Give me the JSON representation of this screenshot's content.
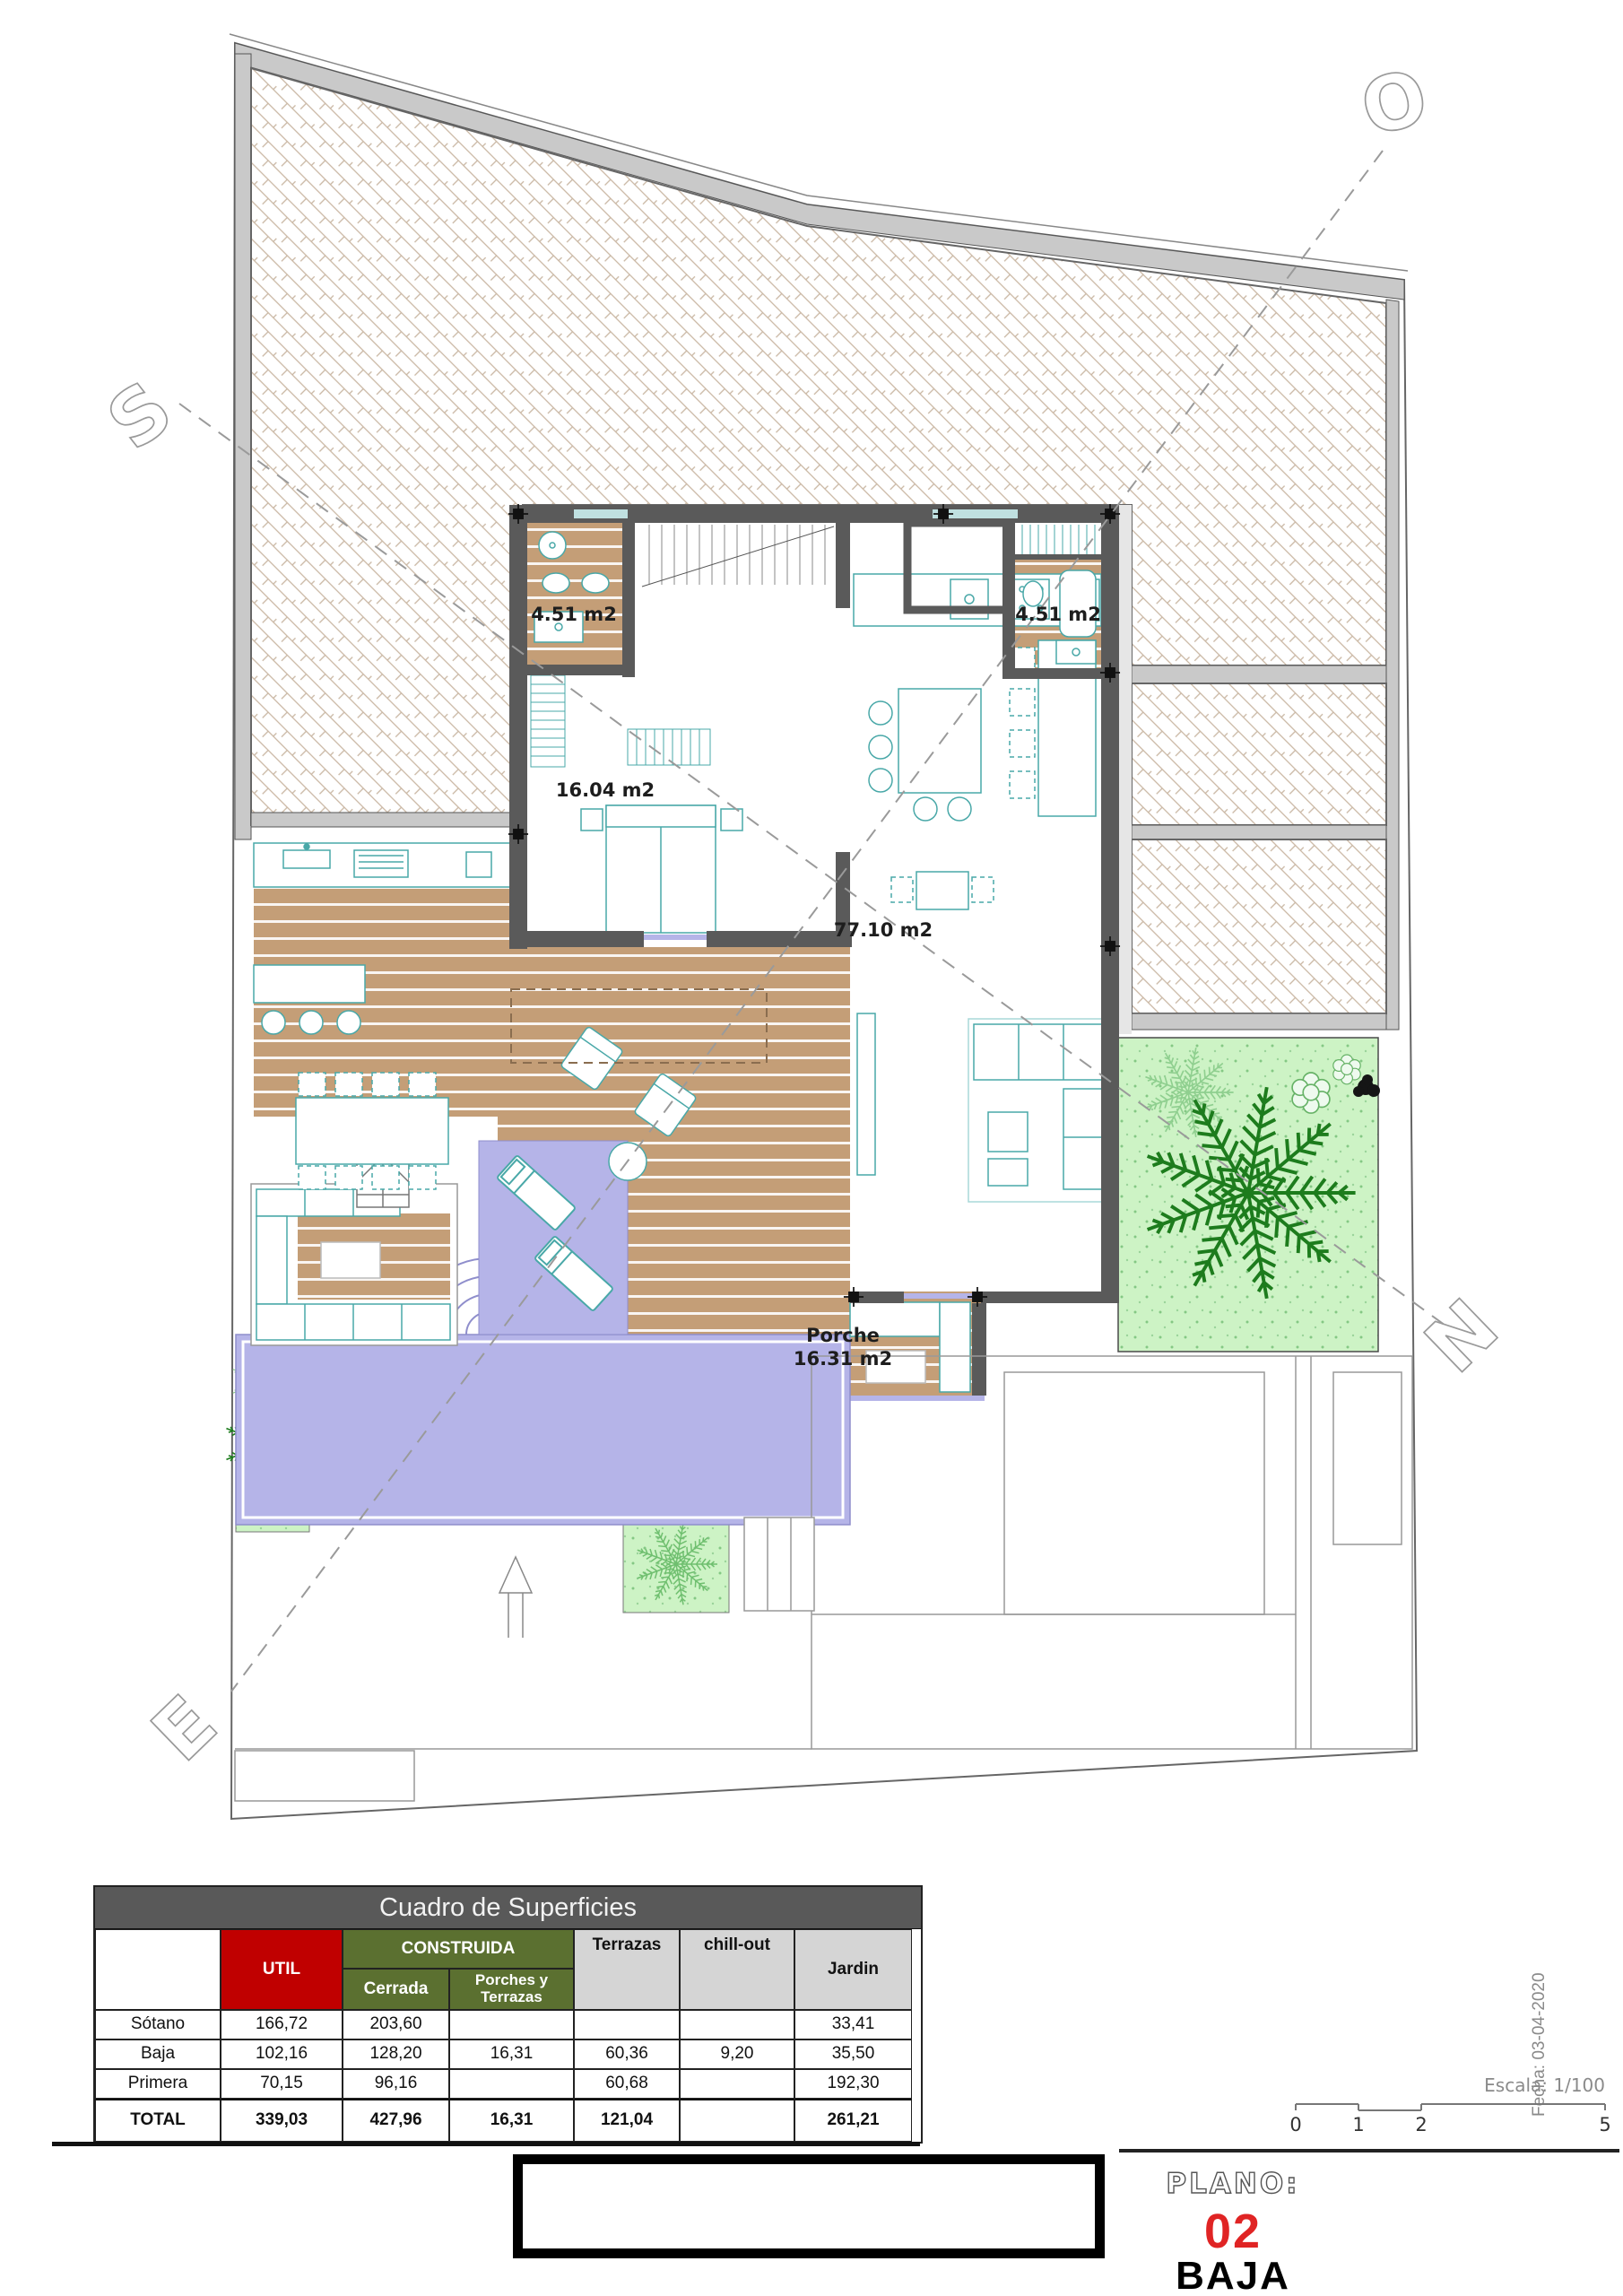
{
  "plan": {
    "compass": {
      "s": "S",
      "o": "O",
      "n": "N",
      "e": "E"
    },
    "labels": {
      "bath_left": "4.51 m2",
      "bath_right": "4.51 m2",
      "bedroom": "16.04 m2",
      "living": "77.10 m2",
      "porch_name": "Porche",
      "porch_area": "16.31 m2"
    }
  },
  "areas_table": {
    "title": "Cuadro de Superficies",
    "headers": {
      "util": "UTIL",
      "construida": "CONSTRUIDA",
      "cerrada": "Cerrada",
      "porches": "Porches y Terrazas",
      "terrazas": "Terrazas",
      "chillout": "chill-out",
      "jardin": "Jardin"
    },
    "rows": [
      {
        "label": "Sótano",
        "util": "166,72",
        "cerrada": "203,60",
        "porches": "",
        "terrazas": "",
        "chillout": "",
        "jardin": "33,41"
      },
      {
        "label": "Baja",
        "util": "102,16",
        "cerrada": "128,20",
        "porches": "16,31",
        "terrazas": "60,36",
        "chillout": "9,20",
        "jardin": "35,50"
      },
      {
        "label": "Primera",
        "util": "70,15",
        "cerrada": "96,16",
        "porches": "",
        "terrazas": "60,68",
        "chillout": "",
        "jardin": "192,30"
      },
      {
        "label": "TOTAL",
        "util": "339,03",
        "cerrada": "427,96",
        "porches": "16,31",
        "terrazas": "121,04",
        "chillout": "",
        "jardin": "261,21"
      }
    ]
  },
  "titleblock": {
    "plano": "PLANO:",
    "number": "02",
    "name": "BAJA"
  },
  "meta": {
    "escala": "Escala: 1/100",
    "fecha": "Fecha: 03-04-2020",
    "scale_ticks": [
      "0",
      "1",
      "2",
      "5"
    ]
  },
  "colors": {
    "accent_red": "#C00000",
    "header_gray": "#595959",
    "construida_green": "#5B7030",
    "pool_lavender": "#B5B4E8",
    "deck_tan": "#C49E77",
    "garden_green": "#CDF3C5",
    "plan_number_red": "#E02424"
  }
}
